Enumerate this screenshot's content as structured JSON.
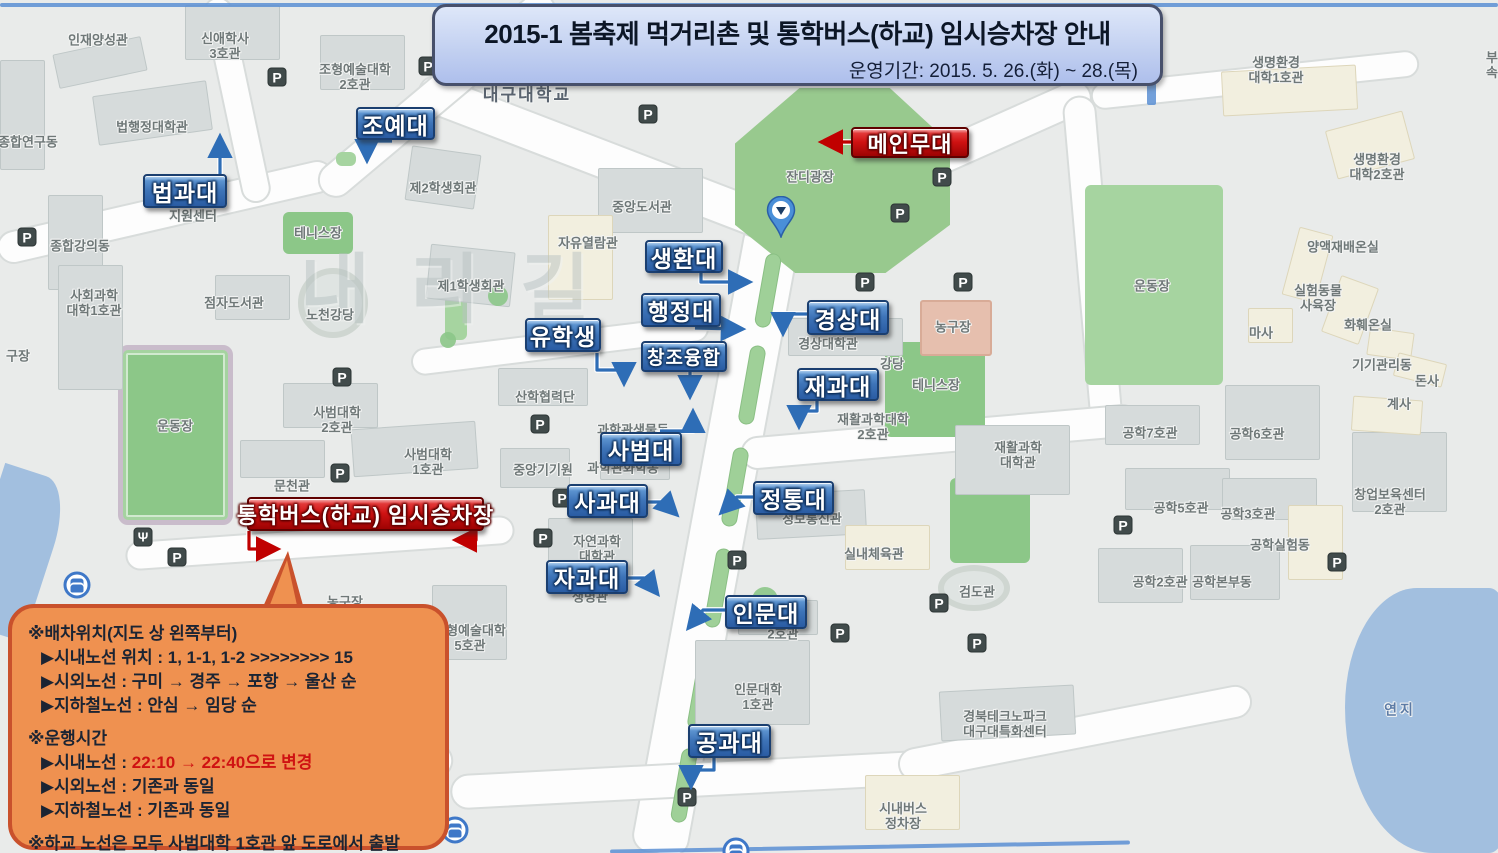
{
  "banner": {
    "title": "2015-1 봄축제 먹거리촌 및 통학버스(하교) 임시승차장 안내",
    "subtitle": "운영기간: 2015. 5. 26.(화) ~ 28.(목)"
  },
  "callouts": [
    {
      "label": "조예대",
      "type": "blue",
      "x": 356,
      "y": 107,
      "w": 79,
      "h": 33,
      "fs": 23
    },
    {
      "label": "법과대",
      "type": "blue",
      "x": 143,
      "y": 174,
      "w": 84,
      "h": 34,
      "fs": 23
    },
    {
      "label": "생환대",
      "type": "blue",
      "x": 645,
      "y": 240,
      "w": 78,
      "h": 33,
      "fs": 23
    },
    {
      "label": "행정대",
      "type": "blue",
      "x": 641,
      "y": 293,
      "w": 80,
      "h": 34,
      "fs": 23
    },
    {
      "label": "유학생",
      "type": "blue",
      "x": 525,
      "y": 318,
      "w": 76,
      "h": 34,
      "fs": 23
    },
    {
      "label": "창조융합",
      "type": "blue",
      "x": 641,
      "y": 341,
      "w": 86,
      "h": 31,
      "fs": 19
    },
    {
      "label": "경상대",
      "type": "blue",
      "x": 807,
      "y": 300,
      "w": 82,
      "h": 35,
      "fs": 23
    },
    {
      "label": "재과대",
      "type": "blue",
      "x": 797,
      "y": 368,
      "w": 82,
      "h": 33,
      "fs": 23
    },
    {
      "label": "사범대",
      "type": "blue",
      "x": 600,
      "y": 432,
      "w": 82,
      "h": 34,
      "fs": 23
    },
    {
      "label": "사과대",
      "type": "blue",
      "x": 567,
      "y": 484,
      "w": 81,
      "h": 34,
      "fs": 23
    },
    {
      "label": "정통대",
      "type": "blue",
      "x": 753,
      "y": 481,
      "w": 81,
      "h": 34,
      "fs": 23
    },
    {
      "label": "자과대",
      "type": "blue",
      "x": 546,
      "y": 560,
      "w": 82,
      "h": 34,
      "fs": 23
    },
    {
      "label": "인문대",
      "type": "blue",
      "x": 725,
      "y": 595,
      "w": 82,
      "h": 34,
      "fs": 23
    },
    {
      "label": "공과대",
      "type": "blue",
      "x": 688,
      "y": 724,
      "w": 83,
      "h": 34,
      "fs": 23
    },
    {
      "label": "메인무대",
      "type": "red",
      "x": 851,
      "y": 127,
      "w": 118,
      "h": 31,
      "fs": 22
    },
    {
      "label": "통학버스(하교) 임시승차장",
      "type": "red",
      "x": 247,
      "y": 497,
      "w": 237,
      "h": 34,
      "fs": 22
    }
  ],
  "arrows": [
    {
      "c": "blue",
      "pts": [
        [
          392,
          141
        ],
        [
          367,
          141
        ],
        [
          367,
          158
        ]
      ]
    },
    {
      "c": "blue",
      "pts": [
        [
          220,
          176
        ],
        [
          220,
          139
        ]
      ]
    },
    {
      "c": "blue",
      "pts": [
        [
          701,
          273
        ],
        [
          701,
          282
        ],
        [
          747,
          282
        ]
      ]
    },
    {
      "c": "blue",
      "pts": [
        [
          695,
          328
        ],
        [
          740,
          329
        ]
      ]
    },
    {
      "c": "blue",
      "pts": [
        [
          597,
          353
        ],
        [
          597,
          370
        ],
        [
          624,
          370
        ],
        [
          624,
          381
        ]
      ]
    },
    {
      "c": "blue",
      "pts": [
        [
          690,
          372
        ],
        [
          690,
          394
        ]
      ]
    },
    {
      "c": "blue",
      "pts": [
        [
          807,
          314
        ],
        [
          783,
          314
        ],
        [
          783,
          331
        ]
      ]
    },
    {
      "c": "blue",
      "pts": [
        [
          817,
          400
        ],
        [
          817,
          411
        ],
        [
          799,
          411
        ],
        [
          799,
          424
        ]
      ]
    },
    {
      "c": "blue",
      "pts": [
        [
          660,
          431
        ],
        [
          693,
          431
        ],
        [
          693,
          414
        ]
      ]
    },
    {
      "c": "blue",
      "pts": [
        [
          648,
          502
        ],
        [
          664,
          502
        ],
        [
          675,
          513
        ]
      ]
    },
    {
      "c": "blue",
      "pts": [
        [
          753,
          497
        ],
        [
          737,
          497
        ],
        [
          723,
          511
        ]
      ]
    },
    {
      "c": "blue",
      "pts": [
        [
          628,
          578
        ],
        [
          645,
          578
        ],
        [
          656,
          592
        ]
      ]
    },
    {
      "c": "blue",
      "pts": [
        [
          725,
          610
        ],
        [
          703,
          610
        ],
        [
          690,
          626
        ]
      ]
    },
    {
      "c": "blue",
      "pts": [
        [
          714,
          758
        ],
        [
          714,
          770
        ],
        [
          691,
          770
        ],
        [
          691,
          784
        ]
      ]
    },
    {
      "c": "red",
      "pts": [
        [
          852,
          142
        ],
        [
          824,
          142
        ]
      ]
    },
    {
      "c": "red",
      "pts": [
        [
          249,
          531
        ],
        [
          249,
          549
        ],
        [
          275,
          549
        ]
      ]
    },
    {
      "c": "red",
      "pts": [
        [
          476,
          531
        ],
        [
          476,
          540
        ],
        [
          458,
          540
        ]
      ]
    }
  ],
  "bubble": {
    "sections": [
      {
        "header": "※배차위치(지도 상 왼쪽부터)",
        "items": [
          "▶시내노선 위치 : 1, 1-1, 1-2 >>>>>>>> 15",
          "▶시외노선 : 구미 → 경주 → 포항 → 울산 순",
          "▶지하철노선 : 안심 → 임당 순"
        ]
      },
      {
        "header": "※운행시간",
        "items": [
          {
            "prefix": "▶시내노선 : ",
            "highlight": "22:10 → 22:40으로 변경"
          },
          "▶시외노선 : 기존과 동일",
          "▶지하철노선 : 기존과 동일"
        ]
      },
      {
        "header": "※하교 노선은 모두 사범대학 1호관 앞 도로에서 출발",
        "items": [
          "하며 통학버스에 부착된 노선번호(명) 확인 요망"
        ]
      }
    ]
  },
  "map": {
    "watermark": "내리길",
    "labels": [
      {
        "t": "인재양성관",
        "x": 98,
        "y": 40
      },
      {
        "t": "신애학사\n3호관",
        "x": 225,
        "y": 46
      },
      {
        "t": "조형예술대학\n2호관",
        "x": 355,
        "y": 77
      },
      {
        "t": "대구대학교",
        "x": 527,
        "y": 95,
        "cls": "big"
      },
      {
        "t": "법행정대학관",
        "x": 152,
        "y": 127
      },
      {
        "t": "종합연구동",
        "x": 28,
        "y": 142
      },
      {
        "t": "지원센터",
        "x": 193,
        "y": 216
      },
      {
        "t": "테니스장",
        "x": 318,
        "y": 233
      },
      {
        "t": "제2학생회관",
        "x": 443,
        "y": 188
      },
      {
        "t": "종합강의동",
        "x": 80,
        "y": 246
      },
      {
        "t": "사회과학\n대학1호관",
        "x": 94,
        "y": 303
      },
      {
        "t": "점자도서관",
        "x": 234,
        "y": 303
      },
      {
        "t": "중앙도서관",
        "x": 642,
        "y": 207
      },
      {
        "t": "자유열람관",
        "x": 588,
        "y": 243
      },
      {
        "t": "제1학생회관",
        "x": 471,
        "y": 286
      },
      {
        "t": "노천강당",
        "x": 330,
        "y": 315
      },
      {
        "t": "잔디광장",
        "x": 810,
        "y": 177
      },
      {
        "t": "경상대학관",
        "x": 828,
        "y": 344
      },
      {
        "t": "강당",
        "x": 892,
        "y": 364
      },
      {
        "t": "농구장",
        "x": 953,
        "y": 327
      },
      {
        "t": "테니스장",
        "x": 936,
        "y": 385
      },
      {
        "t": "재활과학대학\n2호관",
        "x": 873,
        "y": 427
      },
      {
        "t": "재활과학\n대학관",
        "x": 1018,
        "y": 455
      },
      {
        "t": "운동장",
        "x": 175,
        "y": 426
      },
      {
        "t": "운동장",
        "x": 1152,
        "y": 286
      },
      {
        "t": "양액재배온실",
        "x": 1343,
        "y": 247
      },
      {
        "t": "실험동물\n사육장",
        "x": 1318,
        "y": 298
      },
      {
        "t": "마사",
        "x": 1261,
        "y": 333
      },
      {
        "t": "화훼온실",
        "x": 1368,
        "y": 325
      },
      {
        "t": "기기관리동",
        "x": 1382,
        "y": 365
      },
      {
        "t": "돈사",
        "x": 1427,
        "y": 381
      },
      {
        "t": "계사",
        "x": 1399,
        "y": 404
      },
      {
        "t": "생명환경\n대학1호관",
        "x": 1276,
        "y": 70
      },
      {
        "t": "생명환경\n대학2호관",
        "x": 1377,
        "y": 167
      },
      {
        "t": "부속",
        "x": 1492,
        "y": 65
      },
      {
        "t": "공학7호관",
        "x": 1150,
        "y": 433
      },
      {
        "t": "공학6호관",
        "x": 1257,
        "y": 434
      },
      {
        "t": "공학5호관",
        "x": 1181,
        "y": 508
      },
      {
        "t": "공학3호관",
        "x": 1248,
        "y": 514
      },
      {
        "t": "창업보육센터\n2호관",
        "x": 1390,
        "y": 502
      },
      {
        "t": "공학실험동",
        "x": 1280,
        "y": 545
      },
      {
        "t": "공학2호관",
        "x": 1160,
        "y": 582
      },
      {
        "t": "공학본부동",
        "x": 1222,
        "y": 582
      },
      {
        "t": "문천관",
        "x": 292,
        "y": 486
      },
      {
        "t": "사범대학\n2호관",
        "x": 337,
        "y": 420
      },
      {
        "t": "사범대학\n1호관",
        "x": 428,
        "y": 462
      },
      {
        "t": "산학협력단",
        "x": 545,
        "y": 397
      },
      {
        "t": "중앙기기원",
        "x": 543,
        "y": 470
      },
      {
        "t": "과학관생물동",
        "x": 633,
        "y": 430
      },
      {
        "t": "과학관화학동",
        "x": 623,
        "y": 468
      },
      {
        "t": "자연과학\n대학관",
        "x": 597,
        "y": 549
      },
      {
        "t": "생명관",
        "x": 590,
        "y": 597
      },
      {
        "t": "정보통신관",
        "x": 812,
        "y": 519
      },
      {
        "t": "실내체육관",
        "x": 874,
        "y": 554
      },
      {
        "t": "검도관",
        "x": 977,
        "y": 592
      },
      {
        "t": "2호관",
        "x": 783,
        "y": 634
      },
      {
        "t": "인문대학\n1호관",
        "x": 758,
        "y": 697
      },
      {
        "t": "경북테크노파크\n대구대특화센터",
        "x": 1005,
        "y": 724
      },
      {
        "t": "시내버스\n정차장",
        "x": 903,
        "y": 816
      },
      {
        "t": "조형예술대학\n5호관",
        "x": 470,
        "y": 638
      },
      {
        "t": "농구장",
        "x": 345,
        "y": 602
      },
      {
        "t": "구장",
        "x": 18,
        "y": 356
      },
      {
        "t": "연지",
        "x": 1400,
        "y": 710,
        "cls": "waterlab"
      }
    ],
    "parking_icons": [
      [
        27,
        237
      ],
      [
        277,
        77
      ],
      [
        428,
        66
      ],
      [
        648,
        114
      ],
      [
        942,
        177
      ],
      [
        900,
        213
      ],
      [
        865,
        282
      ],
      [
        963,
        282
      ],
      [
        342,
        377
      ],
      [
        540,
        424
      ],
      [
        340,
        473
      ],
      [
        177,
        557
      ],
      [
        562,
        498
      ],
      [
        543,
        538
      ],
      [
        737,
        560
      ],
      [
        840,
        633
      ],
      [
        939,
        603
      ],
      [
        977,
        643
      ],
      [
        687,
        797
      ],
      [
        1123,
        525
      ],
      [
        1337,
        562
      ]
    ],
    "bus_icons": [
      [
        77,
        585
      ],
      [
        455,
        830
      ],
      [
        736,
        851
      ]
    ],
    "restaurant_icons": [
      [
        143,
        537
      ]
    ],
    "pin": {
      "x": 781,
      "y": 243
    }
  }
}
